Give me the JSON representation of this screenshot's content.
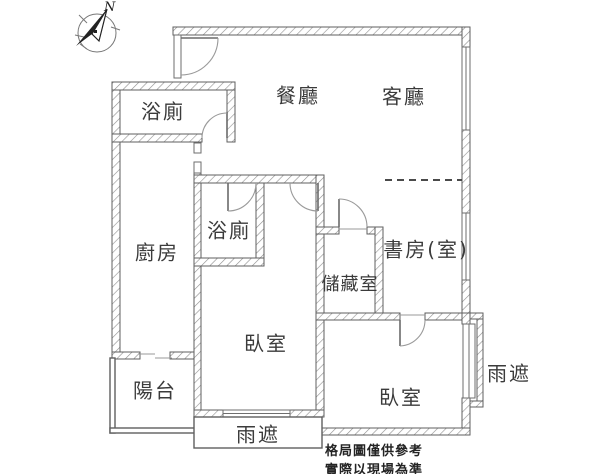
{
  "compass": {
    "north_label": "N"
  },
  "rooms": {
    "bathroom_top": {
      "label": "浴廁"
    },
    "dining": {
      "label": "餐廳"
    },
    "living": {
      "label": "客廳"
    },
    "kitchen": {
      "label": "廚房"
    },
    "bathroom_mid": {
      "label": "浴廁"
    },
    "study": {
      "label": "書房(室)"
    },
    "storage": {
      "label": "儲藏室"
    },
    "bedroom_left": {
      "label": "臥室"
    },
    "bedroom_right": {
      "label": "臥室"
    },
    "balcony": {
      "label": "陽台"
    },
    "rain_shelter_right": {
      "label": "雨遮"
    },
    "rain_shelter_bottom": {
      "label": "雨遮"
    }
  },
  "disclaimer": {
    "line1": "格局圖僅供參考",
    "line2": "實際以現場為準"
  },
  "colors": {
    "wall_stroke": "#5f5f5f",
    "hatch_line": "#8f8f8f",
    "label_text": "#3b3b3b",
    "dashed_partition": "#4a4a4a"
  }
}
